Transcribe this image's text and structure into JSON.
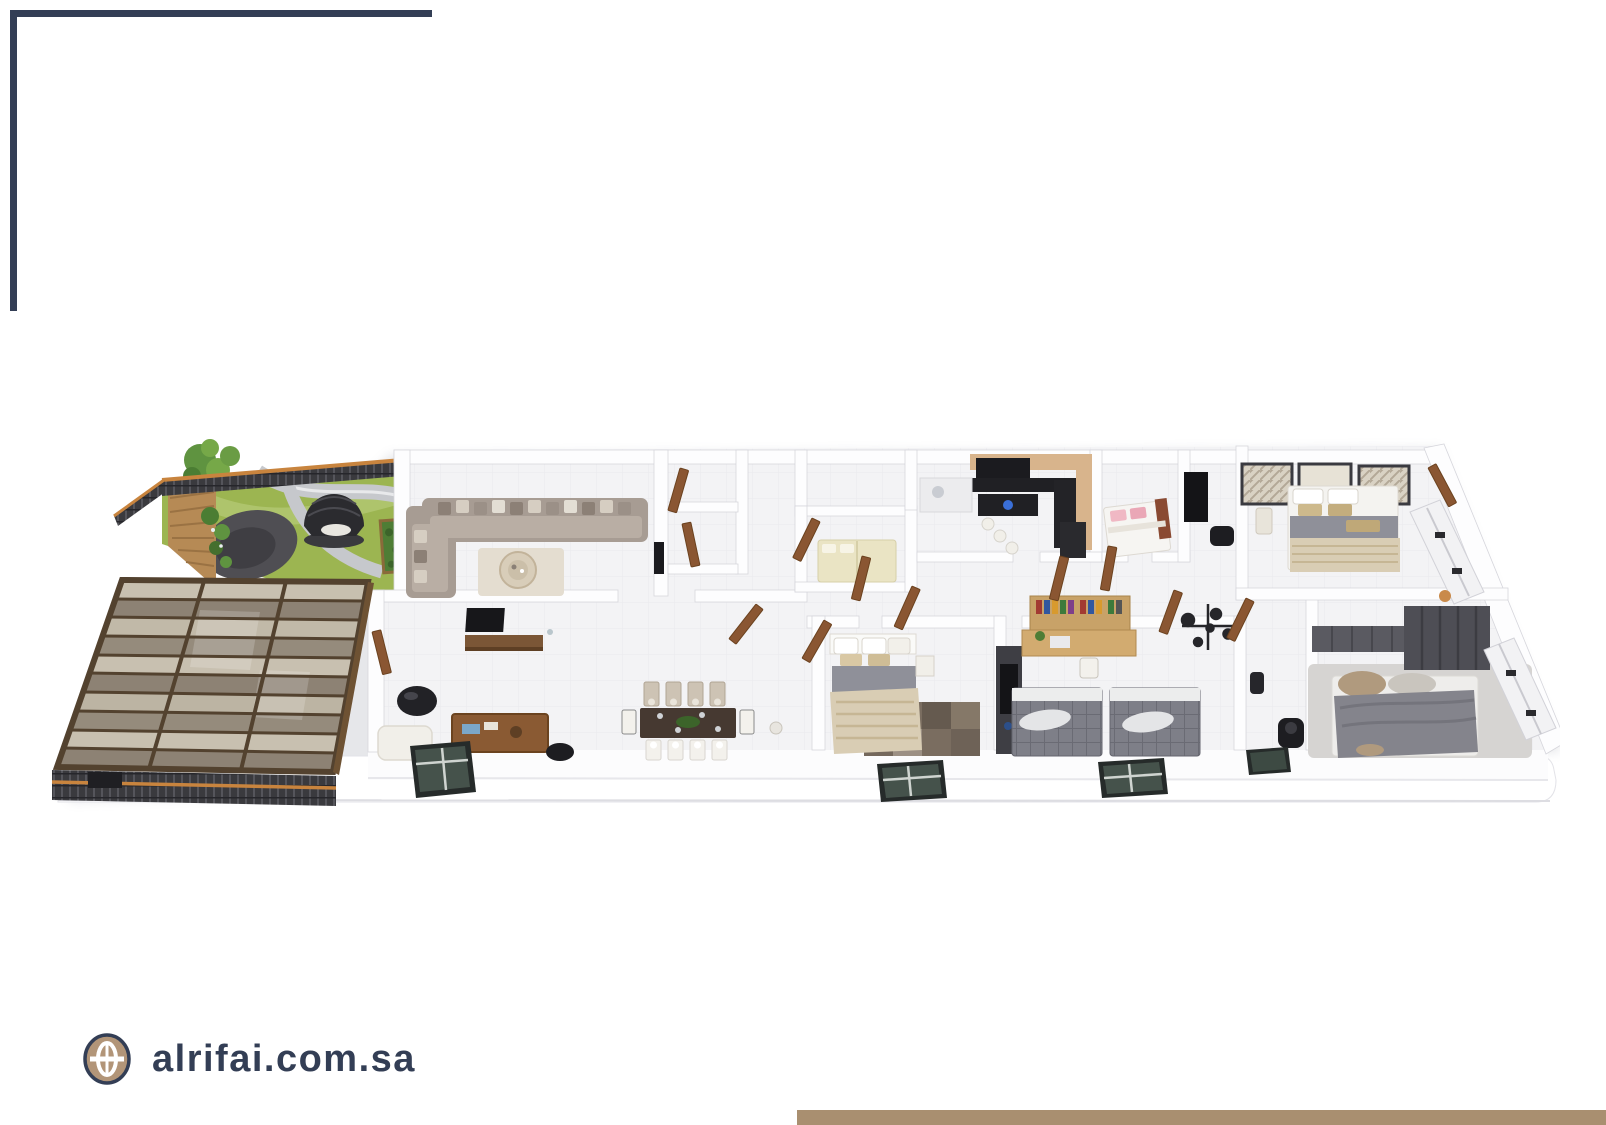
{
  "footer": {
    "website": "alrifai.com.sa",
    "globe_icon": "globe-icon"
  },
  "branding": {
    "navy": "#333e55",
    "globe_tan": "#b29578",
    "footer_bar_color": "#a98f70"
  },
  "floorplan": {
    "description": "3D isometric apartment floor plan render",
    "palette": {
      "wall": "#fdfdfe",
      "floor": "#f3f3f5",
      "wood_door": "#8a5632",
      "sofa": "#a79c93",
      "sofa_cushion": "#b9aea4",
      "lawn": "#9cb551",
      "path": "#c6c8cc",
      "patio": "#4f4e53",
      "deck_wood": "#b68a55",
      "tree_green": "#5f9340",
      "pergola_glass": "#8d8274",
      "pergola_glass_light": "#cbc4b3",
      "pergola_frame": "#53422f",
      "fence": "#3a3a3e",
      "fence_rail": "#c8843e",
      "kitchen_counter": "#202024",
      "kitchen_cabinet": "#d8b48c",
      "cooktop_glow": "#3a6fd8",
      "bed_gray": "#8f9099",
      "bed_beige": "#d9cdb4",
      "bed_cream": "#eae4c4",
      "bed_pink": "#f0b8c4",
      "plaid_gray": "#7e7f88",
      "rug_dark": "#7a6d60",
      "rug_light": "#d6d4d2",
      "wardrobe_dark": "#4e4e55",
      "dining_table": "#463931",
      "window_glass": "#45524b"
    },
    "rooms": [
      "garden-terrace",
      "pergola-canopy",
      "formal-living-room",
      "family-living-room",
      "dining-area",
      "kitchen",
      "single-bedroom",
      "media-nook",
      "master-bedroom-top-right",
      "master-bedroom-center",
      "study-twin-bedroom",
      "bedroom-bottom-right",
      "bathroom",
      "corridor",
      "utility-rooms"
    ]
  }
}
